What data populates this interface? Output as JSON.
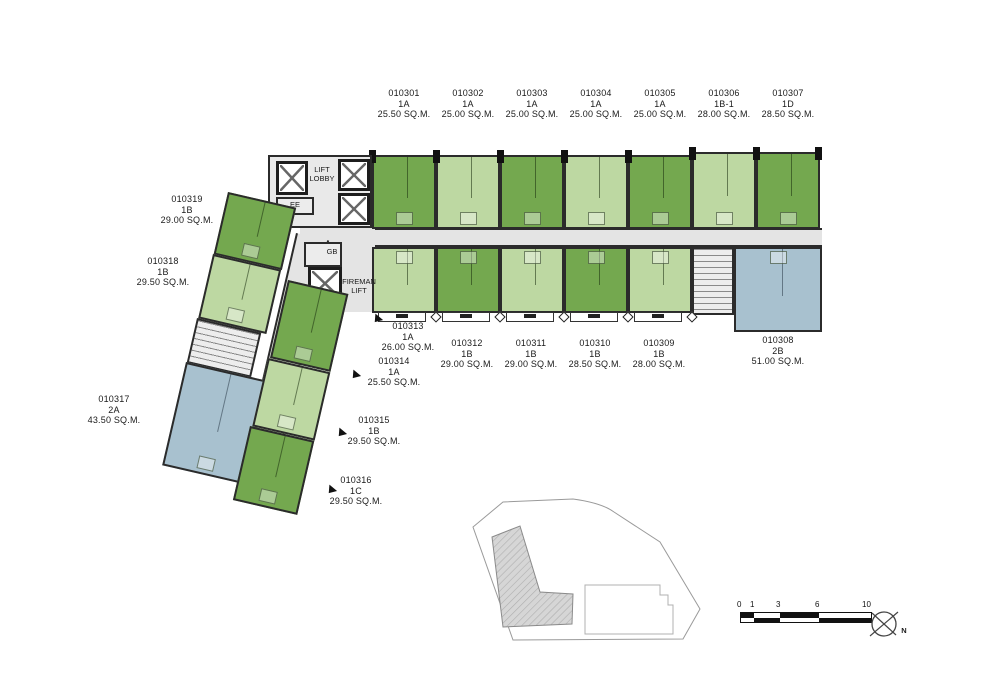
{
  "units": [
    {
      "id": "010301",
      "type": "1A",
      "area": "25.50 SQ.M."
    },
    {
      "id": "010302",
      "type": "1A",
      "area": "25.00 SQ.M."
    },
    {
      "id": "010303",
      "type": "1A",
      "area": "25.00 SQ.M."
    },
    {
      "id": "010304",
      "type": "1A",
      "area": "25.00 SQ.M."
    },
    {
      "id": "010305",
      "type": "1A",
      "area": "25.00 SQ.M."
    },
    {
      "id": "010306",
      "type": "1B-1",
      "area": "28.00 SQ.M."
    },
    {
      "id": "010307",
      "type": "1D",
      "area": "28.50 SQ.M."
    },
    {
      "id": "010308",
      "type": "2B",
      "area": "51.00 SQ.M."
    },
    {
      "id": "010309",
      "type": "1B",
      "area": "28.00 SQ.M."
    },
    {
      "id": "010310",
      "type": "1B",
      "area": "28.50 SQ.M."
    },
    {
      "id": "010311",
      "type": "1B",
      "area": "29.00 SQ.M."
    },
    {
      "id": "010312",
      "type": "1B",
      "area": "29.00 SQ.M."
    },
    {
      "id": "010313",
      "type": "1A",
      "area": "26.00 SQ.M."
    },
    {
      "id": "010314",
      "type": "1A",
      "area": "25.50 SQ.M."
    },
    {
      "id": "010315",
      "type": "1B",
      "area": "29.50 SQ.M."
    },
    {
      "id": "010316",
      "type": "1C",
      "area": "29.50 SQ.M."
    },
    {
      "id": "010317",
      "type": "2A",
      "area": "43.50 SQ.M."
    },
    {
      "id": "010318",
      "type": "1B",
      "area": "29.50 SQ.M."
    },
    {
      "id": "010319",
      "type": "1B",
      "area": "29.00 SQ.M."
    }
  ],
  "texts": {
    "lift_lobby_line1": "LIFT",
    "lift_lobby_line2": "LOBBY",
    "ee": "EE",
    "gb": "GB",
    "fireman_line1": "FIREMAN",
    "fireman_line2": "LIFT",
    "north": "N"
  },
  "scale_bar": {
    "ticks": [
      "0",
      "1",
      "3",
      "6",
      "10"
    ]
  },
  "colors": {
    "unit_dark_green": "#74a84f",
    "unit_light_green": "#bdd8a2",
    "unit_blue": "#a8c1cf",
    "corridor": "#e4e4e4",
    "wall": "#2b2b2b"
  }
}
